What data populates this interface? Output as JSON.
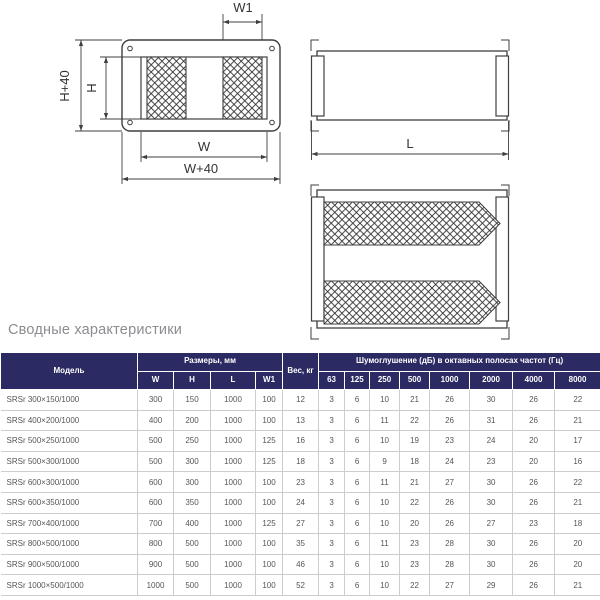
{
  "title": "Сводные характеристики",
  "diagram": {
    "front_view": {
      "w1": "W1",
      "h_plus_40": "H+40",
      "h": "H",
      "w": "W",
      "w_plus_40": "W+40"
    },
    "side_view": {
      "l": "L"
    }
  },
  "table": {
    "col_model": "Модель",
    "group_dims": "Размеры, мм",
    "dim_cols": [
      "W",
      "H",
      "L",
      "W1"
    ],
    "col_weight": "Вес, кг",
    "group_atten": "Шумоглушение (дБ) в октавных полосах частот (Гц)",
    "freq_cols": [
      "63",
      "125",
      "250",
      "500",
      "1000",
      "2000",
      "4000",
      "8000"
    ],
    "rows": [
      [
        "SRSr 300×150/1000",
        "300",
        "150",
        "1000",
        "100",
        "12",
        "3",
        "6",
        "10",
        "21",
        "26",
        "30",
        "26",
        "22"
      ],
      [
        "SRSr 400×200/1000",
        "400",
        "200",
        "1000",
        "100",
        "13",
        "3",
        "6",
        "11",
        "22",
        "26",
        "31",
        "26",
        "21"
      ],
      [
        "SRSr 500×250/1000",
        "500",
        "250",
        "1000",
        "125",
        "16",
        "3",
        "6",
        "10",
        "19",
        "23",
        "24",
        "20",
        "17"
      ],
      [
        "SRSr 500×300/1000",
        "500",
        "300",
        "1000",
        "125",
        "18",
        "3",
        "6",
        "9",
        "18",
        "24",
        "23",
        "20",
        "16"
      ],
      [
        "SRSr 600×300/1000",
        "600",
        "300",
        "1000",
        "100",
        "23",
        "3",
        "6",
        "11",
        "21",
        "27",
        "30",
        "26",
        "22"
      ],
      [
        "SRSr 600×350/1000",
        "600",
        "350",
        "1000",
        "100",
        "24",
        "3",
        "6",
        "10",
        "22",
        "26",
        "30",
        "26",
        "21"
      ],
      [
        "SRSr 700×400/1000",
        "700",
        "400",
        "1000",
        "125",
        "27",
        "3",
        "6",
        "10",
        "20",
        "26",
        "27",
        "23",
        "18"
      ],
      [
        "SRSr 800×500/1000",
        "800",
        "500",
        "1000",
        "100",
        "35",
        "3",
        "6",
        "11",
        "23",
        "28",
        "30",
        "26",
        "20"
      ],
      [
        "SRSr 900×500/1000",
        "900",
        "500",
        "1000",
        "100",
        "46",
        "3",
        "6",
        "10",
        "23",
        "28",
        "30",
        "26",
        "20"
      ],
      [
        "SRSr 1000×500/1000",
        "1000",
        "500",
        "1000",
        "100",
        "52",
        "3",
        "6",
        "10",
        "22",
        "27",
        "29",
        "26",
        "21"
      ]
    ],
    "accent_color": "#2b2a63"
  }
}
